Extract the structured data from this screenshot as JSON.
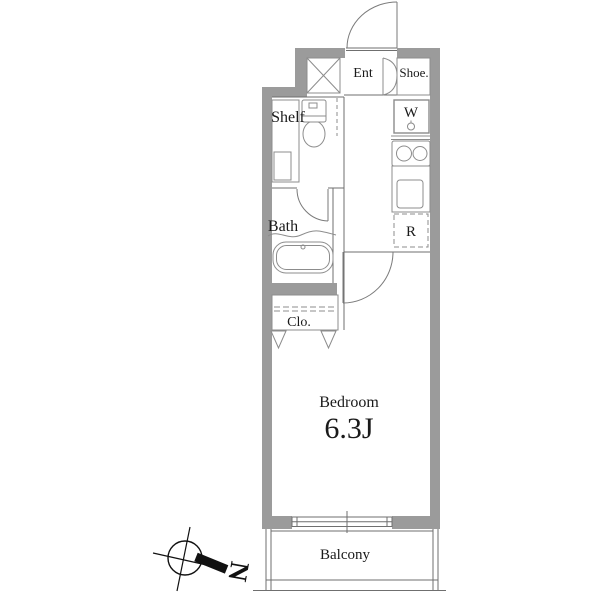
{
  "title": "Apartment floor plan",
  "colors": {
    "wall": "#9b9b9b",
    "line": "#6f6f6f",
    "fixture": "#8c8c8c",
    "door": "#7a7a7a",
    "text": "#1a1a1a",
    "north": "#111111"
  },
  "rooms": {
    "entrance_label": "Ent",
    "shoe_label": "Shoe.",
    "washer_label": "W",
    "fridge_label": "R",
    "shelf_label": "Shelf",
    "bath_label": "Bath",
    "closet_label": "Clo.",
    "bedroom_label": "Bedroom",
    "bedroom_size": "6.3J",
    "balcony_label": "Balcony"
  },
  "compass": {
    "north_label": "N"
  }
}
